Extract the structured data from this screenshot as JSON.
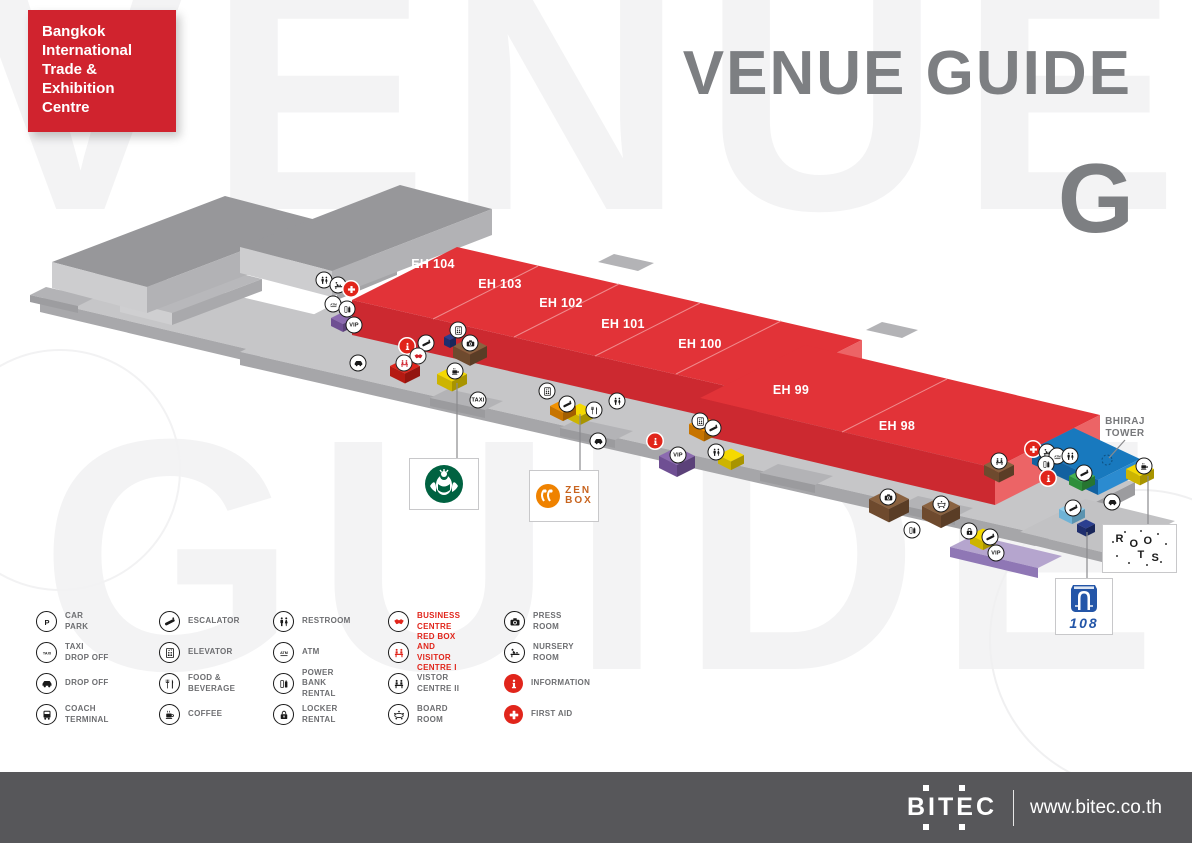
{
  "brand": {
    "lines": [
      "Bangkok",
      "International",
      "Trade &",
      "Exhibition",
      "Centre"
    ]
  },
  "header": {
    "title": "VENUE GUIDE",
    "floor": "G",
    "watermark1": "VENUE",
    "watermark2": "GUIDE"
  },
  "map": {
    "halls": [
      {
        "label": "EH 104",
        "x": 433,
        "y": 264
      },
      {
        "label": "EH 103",
        "x": 500,
        "y": 284
      },
      {
        "label": "EH 102",
        "x": 561,
        "y": 303
      },
      {
        "label": "EH 101",
        "x": 623,
        "y": 324
      },
      {
        "label": "EH 100",
        "x": 700,
        "y": 344
      },
      {
        "label": "EH 99",
        "x": 791,
        "y": 390
      },
      {
        "label": "EH 98",
        "x": 897,
        "y": 426
      }
    ],
    "bhiraj": {
      "line1": "BHIRAJ",
      "line2": "TOWER"
    },
    "icons": [
      {
        "icon": "restroom",
        "x": 324,
        "y": 280,
        "v": "w"
      },
      {
        "icon": "nursery",
        "x": 338,
        "y": 285,
        "v": "w"
      },
      {
        "icon": "first-aid",
        "x": 351,
        "y": 289,
        "v": "r"
      },
      {
        "icon": "atm",
        "x": 333,
        "y": 304,
        "v": "w"
      },
      {
        "icon": "power-bank",
        "x": 347,
        "y": 309,
        "v": "w"
      },
      {
        "icon": "vip",
        "x": 354,
        "y": 325,
        "v": "vip"
      },
      {
        "icon": "drop-off",
        "x": 358,
        "y": 363,
        "v": "w"
      },
      {
        "icon": "info",
        "x": 407,
        "y": 346,
        "v": "r"
      },
      {
        "icon": "escalator",
        "x": 426,
        "y": 343,
        "v": "w"
      },
      {
        "icon": "business",
        "x": 418,
        "y": 356,
        "v": "rg"
      },
      {
        "icon": "red-box",
        "x": 404,
        "y": 363,
        "v": "rg"
      },
      {
        "icon": "elevator",
        "x": 458,
        "y": 330,
        "v": "w"
      },
      {
        "icon": "press",
        "x": 470,
        "y": 343,
        "v": "w"
      },
      {
        "icon": "coffee",
        "x": 455,
        "y": 371,
        "v": "w"
      },
      {
        "icon": "taxi",
        "x": 478,
        "y": 400,
        "v": "taxi"
      },
      {
        "icon": "escalator",
        "x": 567,
        "y": 404,
        "v": "w"
      },
      {
        "icon": "elevator",
        "x": 547,
        "y": 391,
        "v": "w"
      },
      {
        "icon": "food",
        "x": 594,
        "y": 410,
        "v": "w"
      },
      {
        "icon": "restroom",
        "x": 617,
        "y": 401,
        "v": "w"
      },
      {
        "icon": "drop-off",
        "x": 598,
        "y": 441,
        "v": "w"
      },
      {
        "icon": "info",
        "x": 655,
        "y": 441,
        "v": "r"
      },
      {
        "icon": "vip",
        "x": 678,
        "y": 455,
        "v": "vip"
      },
      {
        "icon": "elevator",
        "x": 700,
        "y": 421,
        "v": "w"
      },
      {
        "icon": "escalator",
        "x": 713,
        "y": 428,
        "v": "w"
      },
      {
        "icon": "restroom",
        "x": 716,
        "y": 452,
        "v": "w"
      },
      {
        "icon": "press",
        "x": 888,
        "y": 497,
        "v": "w"
      },
      {
        "icon": "board",
        "x": 941,
        "y": 504,
        "v": "w"
      },
      {
        "icon": "power-bank",
        "x": 912,
        "y": 530,
        "v": "w"
      },
      {
        "icon": "red-box",
        "x": 999,
        "y": 461,
        "v": "w"
      },
      {
        "icon": "locker",
        "x": 969,
        "y": 531,
        "v": "w"
      },
      {
        "icon": "escalator",
        "x": 990,
        "y": 537,
        "v": "w"
      },
      {
        "icon": "first-aid",
        "x": 1033,
        "y": 449,
        "v": "r"
      },
      {
        "icon": "nursery",
        "x": 1047,
        "y": 452,
        "v": "w"
      },
      {
        "icon": "atm",
        "x": 1057,
        "y": 456,
        "v": "w"
      },
      {
        "icon": "restroom",
        "x": 1070,
        "y": 456,
        "v": "w"
      },
      {
        "icon": "power-bank",
        "x": 1046,
        "y": 464,
        "v": "w"
      },
      {
        "icon": "info",
        "x": 1048,
        "y": 478,
        "v": "r"
      },
      {
        "icon": "escalator",
        "x": 1084,
        "y": 473,
        "v": "w"
      },
      {
        "icon": "coffee",
        "x": 1144,
        "y": 466,
        "v": "w"
      },
      {
        "icon": "drop-off",
        "x": 1112,
        "y": 502,
        "v": "w"
      },
      {
        "icon": "escalator",
        "x": 1073,
        "y": 508,
        "v": "w"
      },
      {
        "icon": "vip",
        "x": 996,
        "y": 553,
        "v": "vip"
      }
    ],
    "badges": {
      "vip": "VIP",
      "taxi": "TAXI"
    },
    "logos": {
      "zenbox_top": "ZEN",
      "zenbox_bottom": "BOX",
      "roots_letters": [
        "R",
        "O",
        "O",
        "T",
        "S"
      ],
      "lawson_number": "108"
    }
  },
  "legend": {
    "columns": [
      [
        {
          "icon": "car-park",
          "label": "CAR PARK",
          "style": "outline"
        },
        {
          "icon": "taxi",
          "label": "TAXI DROP OFF",
          "style": "outline"
        },
        {
          "icon": "drop-off",
          "label": "DROP OFF",
          "style": "outline"
        },
        {
          "icon": "coach",
          "label": "COACH TERMINAL",
          "style": "outline"
        }
      ],
      [
        {
          "icon": "escalator",
          "label": "ESCALATOR",
          "style": "outline"
        },
        {
          "icon": "elevator",
          "label": "ELEVATOR",
          "style": "outline"
        },
        {
          "icon": "food",
          "label": "FOOD & BEVERAGE",
          "style": "outline"
        },
        {
          "icon": "coffee",
          "label": "COFFEE",
          "style": "outline"
        }
      ],
      [
        {
          "icon": "restroom",
          "label": "RESTROOM",
          "style": "outline"
        },
        {
          "icon": "atm",
          "label": "ATM",
          "style": "outline"
        },
        {
          "icon": "power-bank",
          "label": "POWER BANK RENTAL",
          "style": "outline"
        },
        {
          "icon": "locker",
          "label": "LOCKER RENTAL",
          "style": "outline"
        }
      ],
      [
        {
          "icon": "business",
          "label": "BUSINESS CENTRE",
          "style": "redglyph",
          "red_text": true
        },
        {
          "icon": "red-box",
          "label": "RED BOX",
          "label2": "AND VISITOR CENTRE I",
          "style": "redglyph",
          "red_text": true
        },
        {
          "icon": "red-box",
          "label": "VISTOR CENTRE II",
          "style": "outline"
        },
        {
          "icon": "board",
          "label": "BOARD ROOM",
          "style": "outline"
        }
      ],
      [
        {
          "icon": "press",
          "label": "PRESS ROOM",
          "style": "outline"
        },
        {
          "icon": "nursery",
          "label": "NURSERY ROOM",
          "style": "outline"
        },
        {
          "icon": "info",
          "label": "INFORMATION",
          "style": "redfill"
        },
        {
          "icon": "first-aid",
          "label": "FIRST AID",
          "style": "redfill"
        }
      ]
    ]
  },
  "footer": {
    "logo": "BITEC",
    "url": "www.bitec.co.th"
  }
}
